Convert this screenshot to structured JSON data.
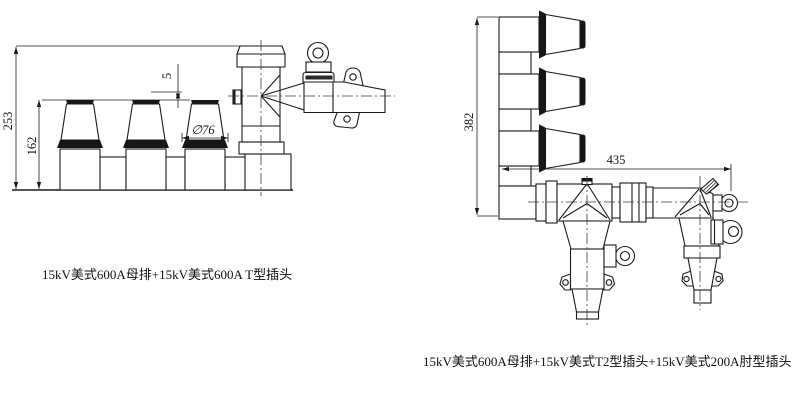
{
  "page": {
    "background": "#ffffff",
    "line_color": "#1b1b1b"
  },
  "left_view": {
    "caption": "15kV美式600A母排+15kV美式600A T型插头",
    "dims": {
      "overall_height": "253",
      "bushing_height": "162",
      "top_offset": "5",
      "bushing_diameter": "∅76"
    }
  },
  "right_view": {
    "caption": "15kV美式600A母排+15kV美式T2型插头+15kV美式200A肘型插头",
    "dims": {
      "overall_height": "382",
      "overall_length": "435"
    }
  }
}
